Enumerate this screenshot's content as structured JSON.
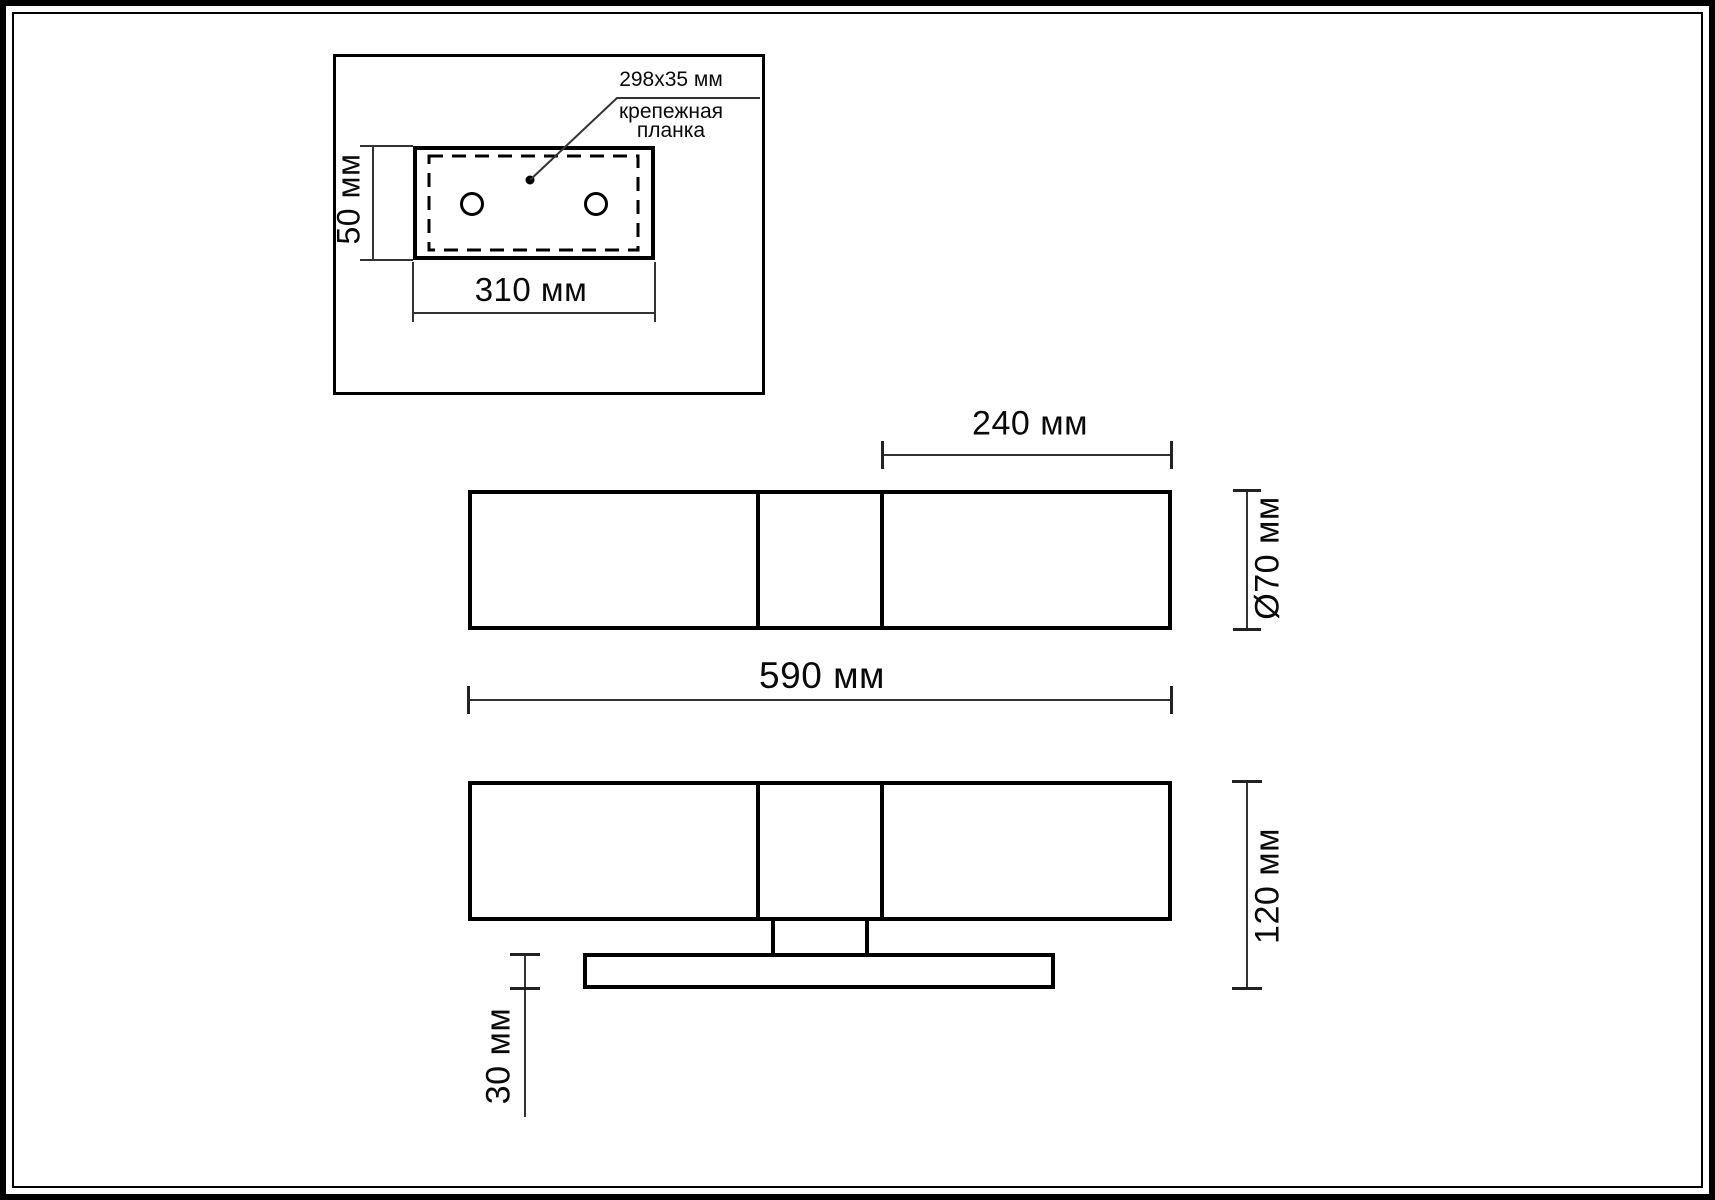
{
  "drawing": {
    "type": "technical-dimension-drawing",
    "line_color": "#000000",
    "background_color": "#ffffff",
    "inset": {
      "annotation_size": "298x35 мм",
      "annotation_name_line1": "крепежная",
      "annotation_name_line2": "планка",
      "dim_plate_height": "50 мм",
      "dim_plate_width": "310 мм",
      "holes_count": 2
    },
    "front_view": {
      "dim_right_section": "240 мм",
      "dim_diameter": "Ø70 мм",
      "dim_total_width": "590 мм"
    },
    "side_view": {
      "dim_total_height": "120 мм",
      "dim_base_thickness": "30 мм"
    }
  }
}
